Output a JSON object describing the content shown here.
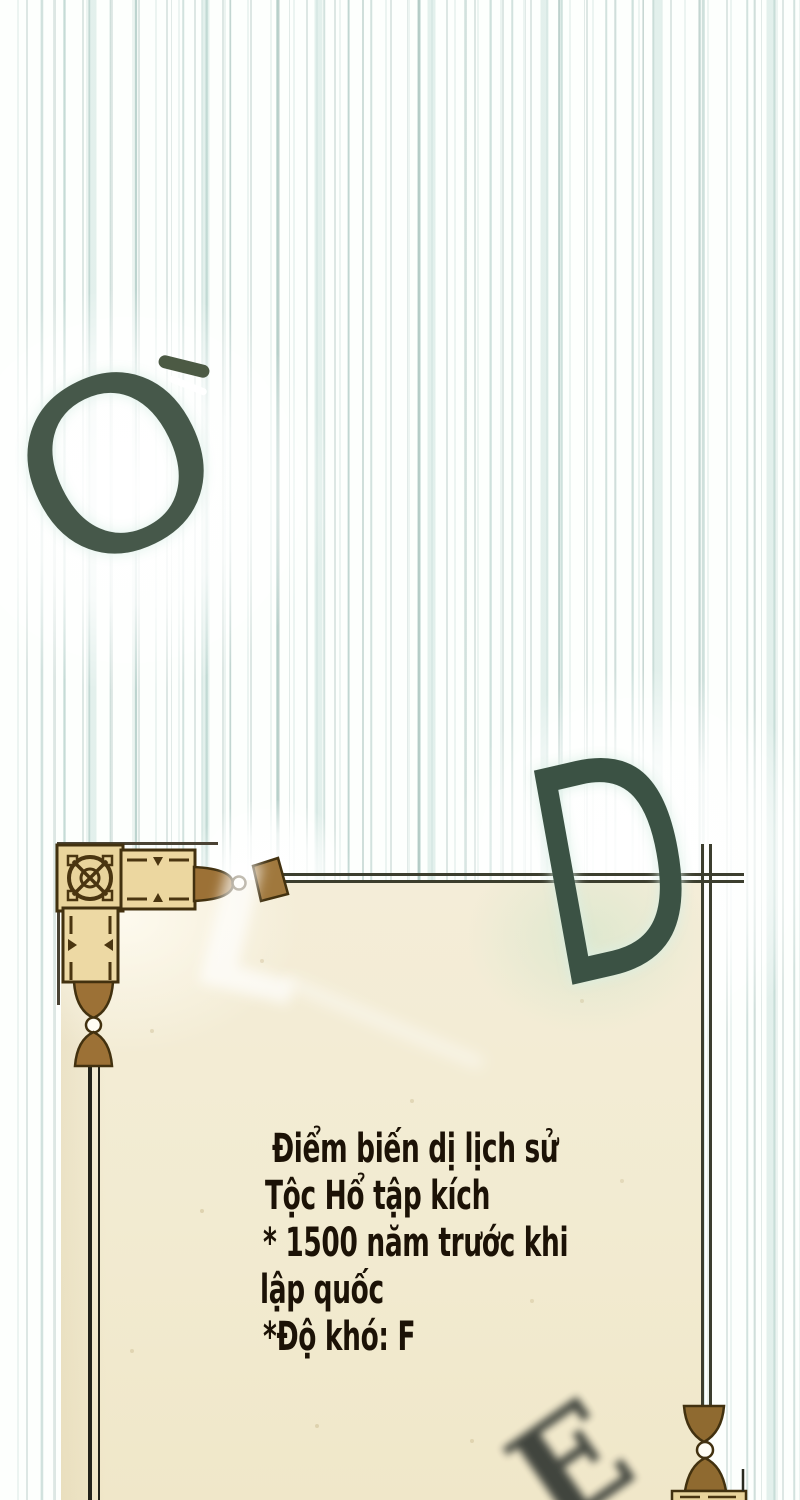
{
  "panel": {
    "scroll_text": {
      "lines": [
        "Điểm biến dị lịch sử",
        "Tộc Hổ tập kích",
        "* 1500 năm trước khi",
        "lập quốc",
        "*Độ khó: F"
      ]
    },
    "floating_letters": {
      "o": "O",
      "l": "L",
      "d": "D",
      "e": "E"
    },
    "colors": {
      "background": "#fdfffd",
      "streak_teal": "#9dbfb8",
      "parchment": "#f2ebd2",
      "ornament_tan": "#e9d49c",
      "ornament_brown": "#9c7136",
      "ornament_outline": "#42310f",
      "border_line": "#3c3e2e",
      "letter_green": "#3e5547",
      "text_color": "#1c1206"
    }
  }
}
